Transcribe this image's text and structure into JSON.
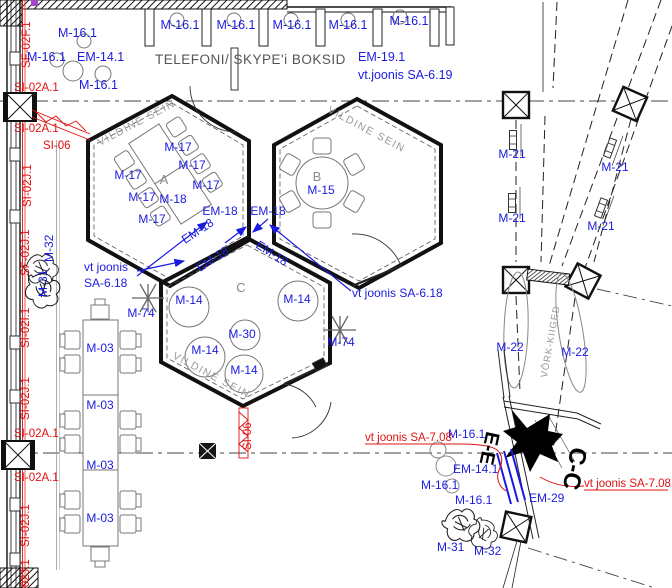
{
  "palette": {
    "blue": "#1b1be0",
    "red": "#e01111",
    "ink": "#111111",
    "furniture_grey": "#777777",
    "wall_text_grey": "#999999"
  },
  "top_booths": {
    "title": "TELEFONI/ SKYPE'i BOKSID",
    "booth_label": "M-16.1",
    "em19_label": "EM-19.1",
    "em19_ref": "vt.joonis SA-6.19",
    "corner_m16": "M-16.1",
    "corner_em14": "EM-14.1"
  },
  "left_wall_marks": {
    "sf02f": "SF-02F.1",
    "si02a": "SI-02A.1",
    "si06": "SI-06",
    "si02j": "SI-02J.1",
    "sf02j": "SF-02J.1",
    "si02i": "SI-02I.1"
  },
  "rooms": {
    "wall_text": "VILDINE SEIN",
    "a": {
      "letter": "A",
      "chair_label": "M-17",
      "table_label": "M-18"
    },
    "b": {
      "letter": "B",
      "table_label": "M-15"
    },
    "c": {
      "letter": "C",
      "beanbag_label": "M-14",
      "pouf_label": "M-30",
      "door_mark": "SI-06"
    },
    "em18_label": "EM-18",
    "ref_left_line1": "vt joonis",
    "ref_left_line2": "SA-6.18",
    "ref_right": "vt joonis SA-6.18",
    "plant_label": "M-74"
  },
  "left_table": {
    "seg_label": "M-03"
  },
  "plant_pair": {
    "m31": "M-31",
    "m32": "M-32"
  },
  "right_zone": {
    "light_label": "M-21",
    "swing_label": "M-22",
    "swing_text": "VÕRK-KIIGED"
  },
  "section_zone": {
    "marker_e": "E-E",
    "marker_c": "C-C",
    "m16": "M-16.1",
    "em14": "EM-14.1",
    "em29": "EM-29",
    "ref": "vt joonis SA-7.08"
  }
}
